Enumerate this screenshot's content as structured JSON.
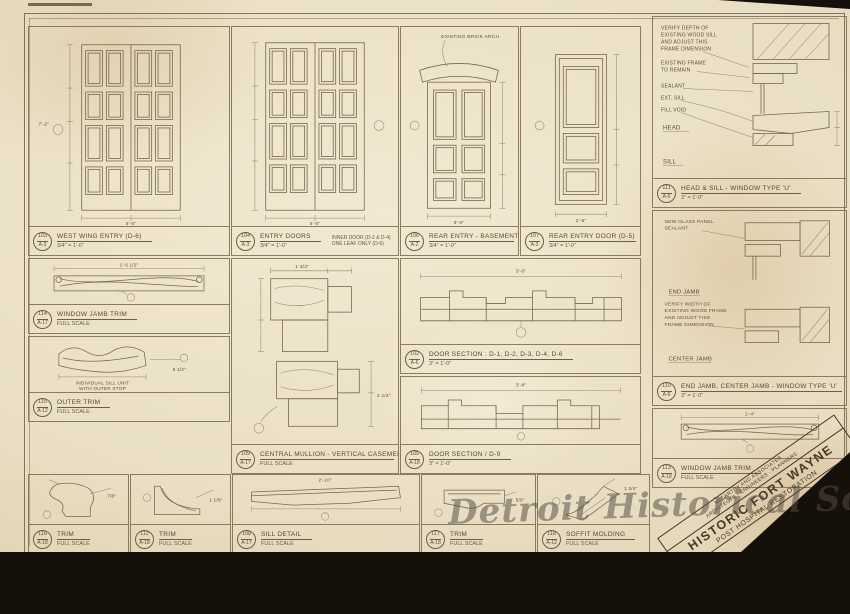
{
  "sheet": {
    "watermark": "Detroit Historical Society"
  },
  "titleblock": {
    "firm_line1": "McCARTHY AND ASSOCIATES",
    "firm_line2": "ARCHITECTS · ENGINEERS · PLANNERS",
    "project": "HISTORIC FORT WAYNE",
    "subtitle": "POST HOSPITAL RESTORATION",
    "scale_note": "SCALE AS SHOWN",
    "job_number": "7610",
    "sheet_prefix": "A",
    "sheet_number": "18"
  },
  "dims": {
    "door_h": "7'-2\"",
    "door_w": "4'-0\"",
    "door3_w": "3'-0\"",
    "door4_w": "2'-8\"",
    "jamb_trim_w": "1'-6 1/2\"",
    "outer_trim_w": "5 1/2\"",
    "mull_a": "1 3/4\"",
    "mull_b": "2 1/4\"",
    "section1_w": "3'-0\"",
    "section2_w": "3'-8\"",
    "sill_w": "2'-10\"",
    "trim2_w": "1'-4\"",
    "trim_a": "7/8\"",
    "trim_b": "1 1/8\"",
    "trim_c": "5/8\"",
    "soffit": "1 3/4\""
  },
  "panels": {
    "door1": {
      "num": "103",
      "ref": "A-3",
      "title": "WEST WING ENTRY (D-6)",
      "scale": "3/4\" = 1'-0\""
    },
    "door2": {
      "num": "104",
      "ref": "A-3",
      "title": "ENTRY DOORS",
      "scale": "3/4\" = 1'-0\"",
      "note1": "INNER DOOR (D-2 & D-4)",
      "note2": "ONE LEAF ONLY (D-6)"
    },
    "door3": {
      "num": "106",
      "ref": "A-2",
      "title": "REAR ENTRY - BASEMENT (D-9)",
      "scale": "3/4\" = 1'-0\"",
      "arch_note": "EXISTING BRICK ARCH"
    },
    "door4": {
      "num": "107",
      "ref": "A-3",
      "title": "REAR ENTRY DOOR (D-5)",
      "scale": "3/4\" = 1'-0\""
    },
    "jamb_trim": {
      "num": "114",
      "ref": "A-17",
      "title": "WINDOW JAMB TRIM",
      "scale": "FULL SCALE"
    },
    "outer_trim": {
      "num": "115",
      "ref": "A-12",
      "title": "OUTER TRIM",
      "scale": "FULL SCALE",
      "note1": "INDIVIDUAL SILL UNIT",
      "note2": "WITH OUTER STOP"
    },
    "central": {
      "num": "109",
      "ref": "A-17",
      "title": "CENTRAL MULLION - VERTICAL CASEMENTS",
      "scale": "FULL SCALE"
    },
    "section1": {
      "num": "102",
      "ref": "A-6",
      "title": "DOOR SECTION : D-1, D-2, D-3, D-4, D-6",
      "scale": "3\" = 1'-0\""
    },
    "section2": {
      "num": "105",
      "ref": "A-18",
      "title": "DOOR SECTION / D-9",
      "scale": "3\" = 1'-0\""
    },
    "head_sill": {
      "num": "111",
      "ref": "A-6",
      "title": "HEAD & SILL - WINDOW TYPE 'U'",
      "scale": "3\" = 1'-0\"",
      "note_a1": "VERIFY DEPTH OF",
      "note_a2": "EXISTING WOOD SILL",
      "note_a3": "AND ADJUST THIS",
      "note_a4": "FRAME DIMENSION",
      "note_b1": "EXISTING FRAME",
      "note_b2": "TO REMAIN",
      "note_c": "SEALANT",
      "note_d": "EXT. SILL",
      "note_e": "FILL VOID",
      "label_head": "HEAD",
      "label_sill": "SILL"
    },
    "jambs": {
      "num": "110",
      "ref": "A-6",
      "title": "END JAMB, CENTER JAMB - WINDOW TYPE 'U'",
      "scale": "3\" = 1'-0\"",
      "note_a1": "NEW GLASS PANEL",
      "note_a2": "SEALANT",
      "note_b1": "VERIFY WIDTH OF",
      "note_b2": "EXISTING WOOD FRAME",
      "note_b3": "AND ADJUST THIS",
      "note_b4": "FRAME DIMENSION",
      "label_end": "END JAMB",
      "label_center": "CENTER JAMB"
    },
    "jamb_trim2": {
      "num": "113",
      "ref": "A-18",
      "title": "WINDOW JAMB TRIM",
      "scale": "FULL SCALE"
    },
    "trim_a": {
      "num": "116",
      "ref": "A-18",
      "title": "TRIM",
      "scale": "FULL SCALE"
    },
    "trim_b": {
      "num": "112",
      "ref": "A-18",
      "title": "TRIM",
      "scale": "FULL SCALE"
    },
    "sill_detail": {
      "num": "108",
      "ref": "A-17",
      "title": "SILL DETAIL",
      "scale": "FULL SCALE"
    },
    "trim_c": {
      "num": "117",
      "ref": "A-18",
      "title": "TRIM",
      "scale": "FULL SCALE"
    },
    "soffit": {
      "num": "118",
      "ref": "A-12",
      "title": "SOFFIT MOLDING",
      "scale": "FULL SCALE"
    }
  }
}
